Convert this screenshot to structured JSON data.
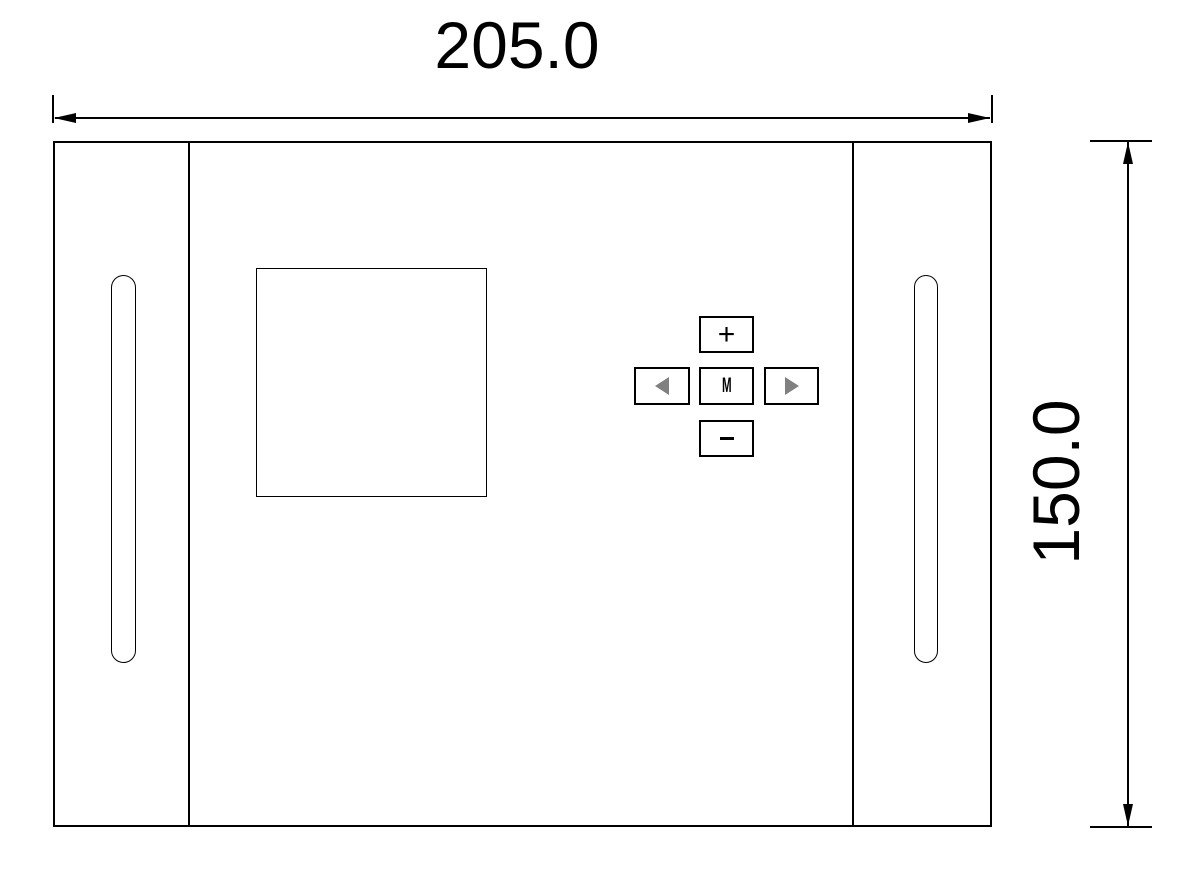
{
  "drawing": {
    "type": "technical-dimension-drawing",
    "width_dimension": "205.0",
    "height_dimension": "150.0"
  },
  "panel": {
    "buttons": {
      "plus": "+",
      "minus": "−",
      "menu": "M"
    },
    "icons": {
      "left": "left-triangle-icon",
      "right": "right-triangle-icon"
    }
  },
  "colors": {
    "line": "#000000",
    "background": "#ffffff",
    "button_triangle_gray": "#808080"
  }
}
